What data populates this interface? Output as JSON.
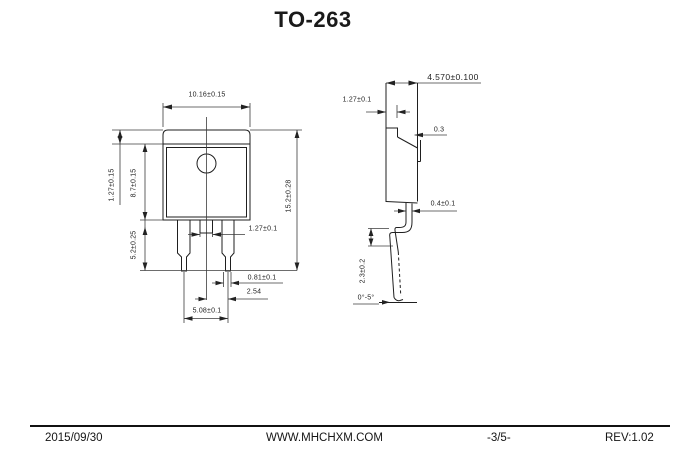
{
  "title": "TO-263",
  "front_view": {
    "dims": {
      "body_width": "10.16±0.15",
      "tab_height": "1.27±0.15",
      "body_height": "8.7±0.15",
      "lead_length": "5.2±0.25",
      "total_height": "15.2±0.28",
      "center_tab_width": "1.27±0.1",
      "lead_width": "0.81±0.1",
      "lead_pitch": "2.54",
      "outer_lead_span": "5.08±0.1"
    }
  },
  "side_view": {
    "dims": {
      "body_thickness": "4.570±0.100",
      "tab_thickness": "1.27±0.1",
      "tab_offset": "0.3",
      "lead_thickness": "0.4±0.1",
      "lead_height": "2.3±0.2",
      "lead_angle": "0°-5°"
    }
  },
  "footer": {
    "date": "2015/09/30",
    "website": "WWW.MHCHXM.COM",
    "page_number": "-3/5-",
    "revision": "REV:1.02"
  },
  "colors": {
    "line": "#1f1f1f",
    "background": "#ffffff"
  }
}
